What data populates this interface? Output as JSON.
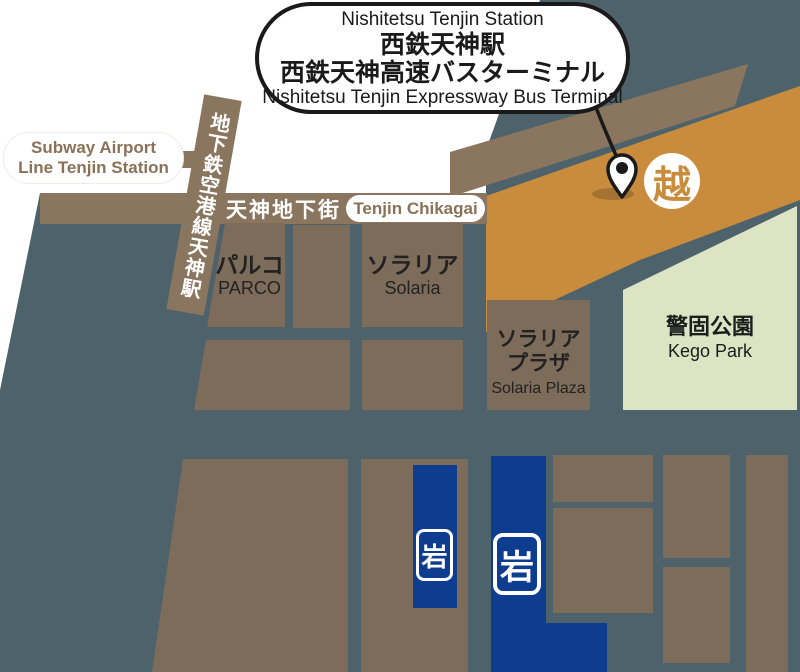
{
  "callout": {
    "title_en": "Nishitetsu Tenjin Station",
    "line1_jp": "西鉄天神駅",
    "line2_jp": "西鉄天神高速バスターミナル",
    "subtitle_en": "Nishitetsu Tenjin Expressway Bus Terminal"
  },
  "stations": {
    "subway_pill_line1": "Subway Airport",
    "subway_pill_line2": "Line Tenjin Station",
    "subway_strip": "地下鉄空港線天神駅"
  },
  "roads": {
    "chikagai_jp": "天神地下街",
    "chikagai_en": "Tenjin Chikagai"
  },
  "buildings": {
    "parco": {
      "jp": "パルコ",
      "en": "PARCO"
    },
    "solaria": {
      "jp": "ソラリア",
      "en": "Solaria"
    },
    "solaria_plaza": {
      "jp1": "ソラリア",
      "jp2": "プラザ",
      "en": "Solaria Plaza"
    },
    "kego_park": {
      "jp": "警固公園",
      "en": "Kego Park"
    }
  },
  "logos": {
    "mitsukoshi": "越",
    "iwataya": "岩"
  },
  "colors": {
    "background_slate": "#4d626b",
    "building_brown": "#7d6c5a",
    "road_brown": "#8a755e",
    "terminal_orange": "#c88c3c",
    "park_green": "#dce4c4",
    "iwataya_blue": "#0e3d90",
    "pill_text_brown": "#8a7158",
    "outline_black": "#1a1a1a"
  }
}
